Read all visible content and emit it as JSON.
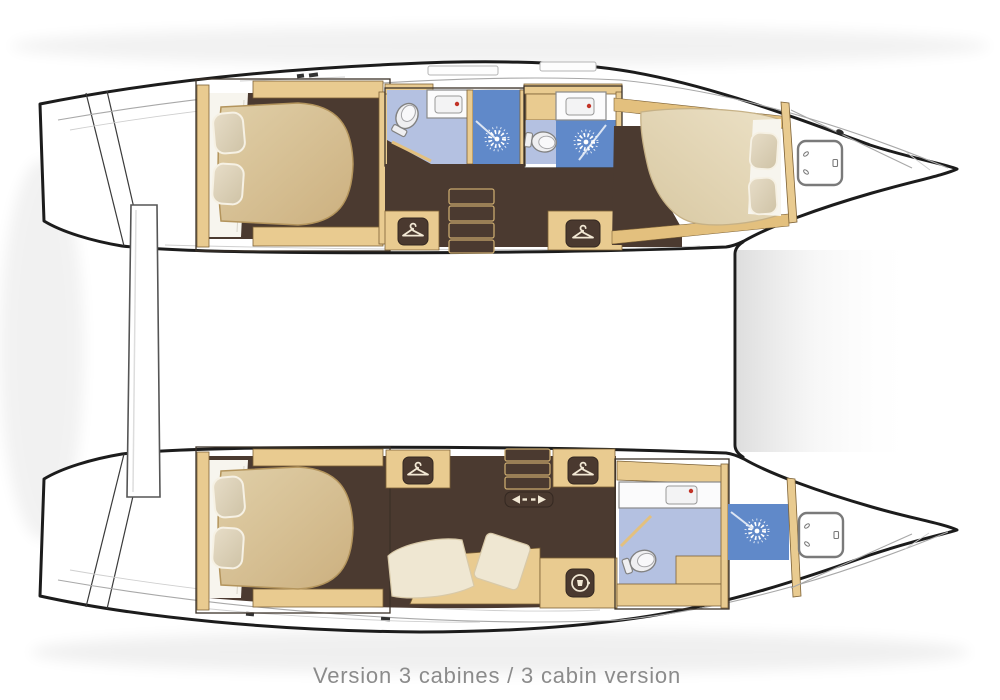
{
  "caption": {
    "text": "Version 3 cabines / 3 cabin version"
  },
  "palette": {
    "hull-outline": "#1c1c1c",
    "hull-fill": "#ffffff",
    "deck-line": "#a8a8a8",
    "wood": "#e9cb90",
    "wood-band": "#e3c07e",
    "wood-edge": "#7c6136",
    "floor-brown": "#4b3a30",
    "mattress-a": "#e0cfa8",
    "mattress-b": "#ccb07f",
    "mattress-fore-a": "#ece1c6",
    "mattress-fore-b": "#d8c8a2",
    "pillow-a": "#e7ddc8",
    "pillow-b": "#cfc3a6",
    "sheet": "#f7f5ee",
    "bath-floor": "#b4c1e1",
    "shower-blue": "#6089c9",
    "fixture": "#efeff1",
    "fixture-edge": "#828282",
    "faucet-red": "#c23327",
    "badge": "#4a392f",
    "badge-glyph": "#f2e8d4",
    "interior-line": "#3c3228",
    "caption": "#8b8b8b"
  },
  "icons": {
    "wardrobe": "hanger-icon",
    "laundry": "washing-machine-icon",
    "shower": "shower-spray-icon",
    "sliding_door": "double-arrow-icon",
    "bow_locker": "deck-hatch-icon",
    "toilet": "toilet-icon",
    "sink": "sink-icon",
    "companionway": "steps-icon"
  }
}
